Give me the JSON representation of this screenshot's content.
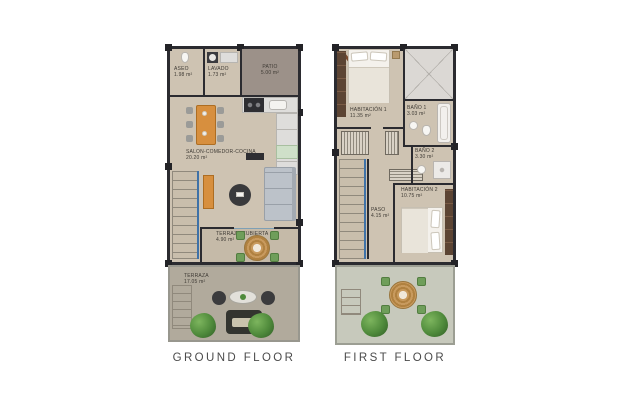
{
  "ground_floor": {
    "caption": "GROUND FLOOR",
    "rooms": {
      "aseo": {
        "name": "ASEO",
        "area": "1.98 m²"
      },
      "lavado": {
        "name": "LAVADO",
        "area": "1.73 m²"
      },
      "patio": {
        "name": "PATIO",
        "area": "5.00 m²"
      },
      "salon": {
        "name": "SALON-COMEDOR-COCINA",
        "area": "20.20 m²"
      },
      "terraza_cubierta": {
        "name": "TERRAZA CUBIERTA",
        "area": "4.90 m²"
      },
      "terraza": {
        "name": "TERRAZA",
        "area": "17.05 m²"
      }
    }
  },
  "first_floor": {
    "caption": "FIRST FLOOR",
    "rooms": {
      "habitacion1": {
        "name": "HABITACIÓN 1",
        "area": "11.35 m²"
      },
      "bano1": {
        "name": "BAÑO 1",
        "area": "3.03 m²"
      },
      "bano2": {
        "name": "BAÑO 2",
        "area": "3.30 m²"
      },
      "habitacion2": {
        "name": "HABITACIÓN 2",
        "area": "10.75 m²"
      },
      "paso": {
        "name": "PASO",
        "area": "4.15 m²"
      }
    }
  },
  "colors": {
    "background": "#ffffff",
    "wall": "#2b2b30",
    "floor_interior": "#cec3b2",
    "patio": "#9c9189",
    "terrace_ground": "#b1aa9c",
    "terrace_first": "#c7c9bc",
    "accent_wood": "#d78f3e",
    "railing_blue": "#3f72a8",
    "greenery": "#4e8a3c",
    "label_text": "#3e3a34",
    "caption_text": "#4b4b4b"
  }
}
